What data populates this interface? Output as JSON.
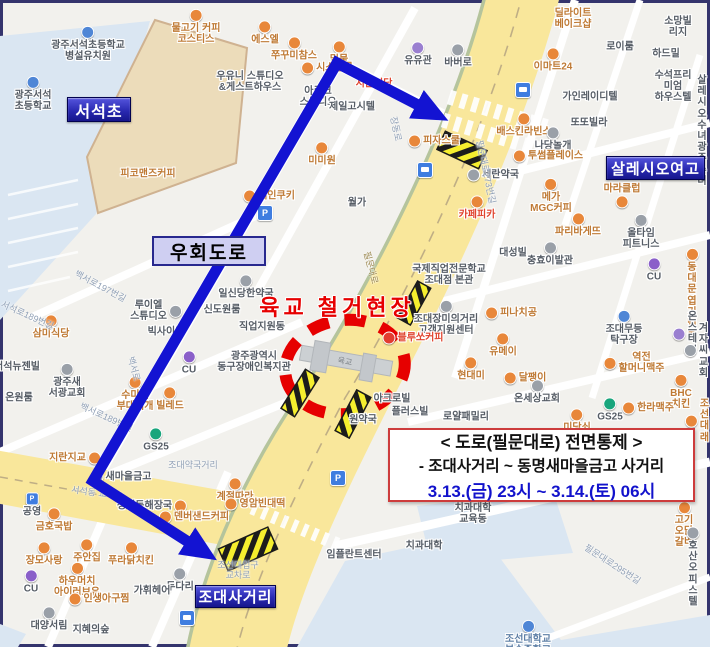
{
  "colors": {
    "map_bg": "#f2f1ed",
    "campus_blue": "#dae6f2",
    "field_tan": "#ecdcba",
    "road_yellow": "#f9e79b",
    "road_edge": "#b5c49c",
    "centerline": "#bfae85",
    "route": "#1313d2",
    "alert_red": "#e60000",
    "hatch_yellow": "#f5ee2e",
    "badge_top": "#5555dd",
    "badge_bottom": "#16168c",
    "badge_border": "#02024f",
    "detour_bg": "#cfcff2",
    "detour_border": "#28288e",
    "notice_border": "#cd3c3c",
    "notice_blue": "#1212cc"
  },
  "annotations": {
    "site_title": "육교 철거현장",
    "detour_label": "우회도로",
    "notice": {
      "title": "< 도로(필문대로) 전면통제 >",
      "range": "- 조대사거리 ~ 동명새마을금고 사거리",
      "time": "3.13.(금) 23시 ~ 3.14.(토) 06시"
    },
    "badges": [
      {
        "label": "서석초",
        "x": 67,
        "y": 97,
        "w": 62,
        "h": 23,
        "fs": 16
      },
      {
        "label": "살레시오여고",
        "x": 606,
        "y": 156,
        "w": 97,
        "h": 22,
        "fs": 15
      },
      {
        "label": "조대사거리",
        "x": 195,
        "y": 585,
        "w": 79,
        "h": 21,
        "fs": 15
      }
    ]
  },
  "map": {
    "pois": [
      {
        "t": "물고기 커피\n코스티스",
        "x": 196,
        "y": 27,
        "c": "food",
        "i": "a",
        "ic": "o"
      },
      {
        "t": "에스엘",
        "x": 265,
        "y": 33,
        "c": "food",
        "i": "a",
        "ic": "o"
      },
      {
        "t": "쭈꾸미참스",
        "x": 294,
        "y": 49,
        "c": "food",
        "i": "a",
        "ic": "o"
      },
      {
        "t": "밀물",
        "x": 339,
        "y": 53,
        "c": "food",
        "i": "a",
        "ic": "o"
      },
      {
        "t": "시스살롱",
        "x": 327,
        "y": 68,
        "c": "food",
        "i": "l",
        "ic": "o"
      },
      {
        "t": "유유관",
        "x": 418,
        "y": 54,
        "c": "gray",
        "i": "a",
        "ic": "v"
      },
      {
        "t": "바버로",
        "x": 458,
        "y": 56,
        "c": "gray",
        "i": "a",
        "ic": "g"
      },
      {
        "t": "광주서석초등학교\n병설유치원",
        "x": 88,
        "y": 44,
        "c": "gray",
        "i": "a",
        "ic": "b"
      },
      {
        "t": "광주서석\n초등학교",
        "x": 33,
        "y": 94,
        "c": "gray",
        "i": "a",
        "ic": "b"
      },
      {
        "t": "우유니 스튜디오\n&게스트하우스",
        "x": 250,
        "y": 82,
        "c": "gray",
        "i": "n"
      },
      {
        "t": "아르크\n스튜디오",
        "x": 318,
        "y": 97,
        "c": "gray",
        "i": "n"
      },
      {
        "t": "제일고시텔",
        "x": 352,
        "y": 107,
        "c": "gray",
        "i": "n"
      },
      {
        "t": "서문식당",
        "x": 374,
        "y": 84,
        "c": "hot",
        "i": "n"
      },
      {
        "t": "미미원",
        "x": 322,
        "y": 154,
        "c": "food",
        "i": "a",
        "ic": "o"
      },
      {
        "t": "피자스쿨",
        "x": 434,
        "y": 141,
        "c": "food",
        "i": "l",
        "ic": "o"
      },
      {
        "t": "딜라이트\n베이크샵",
        "x": 573,
        "y": 19,
        "c": "food",
        "i": "n"
      },
      {
        "t": "소망빌리지",
        "x": 678,
        "y": 27,
        "c": "gray",
        "i": "n"
      },
      {
        "t": "로이룸",
        "x": 620,
        "y": 47,
        "c": "gray",
        "i": "n"
      },
      {
        "t": "하드밀",
        "x": 666,
        "y": 54,
        "c": "gray",
        "i": "n"
      },
      {
        "t": "이마트24",
        "x": 553,
        "y": 60,
        "c": "food",
        "i": "a",
        "ic": "o"
      },
      {
        "t": "가인레이디텔",
        "x": 590,
        "y": 97,
        "c": "gray",
        "i": "n"
      },
      {
        "t": "수석프리미엄\n하우스텔",
        "x": 673,
        "y": 87,
        "c": "gray",
        "i": "n"
      },
      {
        "t": "또또빌라",
        "x": 589,
        "y": 123,
        "c": "gray",
        "i": "n"
      },
      {
        "t": "배스킨라빈스",
        "x": 524,
        "y": 125,
        "c": "food",
        "i": "a",
        "ic": "o"
      },
      {
        "t": "나당놀개",
        "x": 553,
        "y": 139,
        "c": "gray",
        "i": "a",
        "ic": "g"
      },
      {
        "t": "살레시오수녀\n광주수녀",
        "x": 702,
        "y": 131,
        "c": "gray",
        "i": "n"
      },
      {
        "t": "투썸플레이스",
        "x": 548,
        "y": 156,
        "c": "food",
        "i": "l",
        "ic": "o"
      },
      {
        "t": "세란약국",
        "x": 493,
        "y": 175,
        "c": "gray",
        "i": "l",
        "ic": "g"
      },
      {
        "t": "메가\nMGC커피",
        "x": 551,
        "y": 196,
        "c": "food",
        "i": "a",
        "ic": "o"
      },
      {
        "t": "마라클럽",
        "x": 622,
        "y": 196,
        "c": "food",
        "i": "b",
        "ic": "o"
      },
      {
        "t": "카페피카",
        "x": 477,
        "y": 208,
        "c": "hot",
        "i": "a",
        "ic": "o"
      },
      {
        "t": "파리바게뜨",
        "x": 578,
        "y": 225,
        "c": "food",
        "i": "a",
        "ic": "o"
      },
      {
        "t": "올타임\n피트니스",
        "x": 641,
        "y": 232,
        "c": "gray",
        "i": "a",
        "ic": "g"
      },
      {
        "t": "대성빌",
        "x": 513,
        "y": 253,
        "c": "gray",
        "i": "n"
      },
      {
        "t": "충효이발관",
        "x": 550,
        "y": 254,
        "c": "gray",
        "i": "a",
        "ic": "g"
      },
      {
        "t": "CU",
        "x": 654,
        "y": 270,
        "c": "gray",
        "i": "a",
        "ic": "cu"
      },
      {
        "t": "동대문\n엽기떡볶",
        "x": 692,
        "y": 294,
        "c": "food",
        "i": "a",
        "ic": "o"
      },
      {
        "t": "세인쿠키",
        "x": 269,
        "y": 196,
        "c": "food",
        "i": "l",
        "ic": "o"
      },
      {
        "t": "피코맨즈커피",
        "x": 148,
        "y": 174,
        "c": "food",
        "i": "n"
      },
      {
        "t": "월가",
        "x": 357,
        "y": 203,
        "c": "gray",
        "i": "n"
      },
      {
        "t": "국제직업전문학교\n조대점 본관",
        "x": 449,
        "y": 275,
        "c": "gray",
        "i": "n"
      },
      {
        "t": "일신당한약국",
        "x": 246,
        "y": 287,
        "c": "gray",
        "i": "a",
        "ic": "g"
      },
      {
        "t": "신도원룸",
        "x": 222,
        "y": 310,
        "c": "gray",
        "i": "n"
      },
      {
        "t": "직업지원동",
        "x": 262,
        "y": 327,
        "c": "gray",
        "i": "n"
      },
      {
        "t": "루이엘\n스튜디오",
        "x": 156,
        "y": 311,
        "c": "gray",
        "i": "r",
        "ic": "g"
      },
      {
        "t": "빅사이즈",
        "x": 166,
        "y": 332,
        "c": "gray",
        "i": "n"
      },
      {
        "t": "삼미식당",
        "x": 51,
        "y": 327,
        "c": "food",
        "i": "a",
        "ic": "o"
      },
      {
        "t": "광주광역시\n동구장애인복지관",
        "x": 254,
        "y": 362,
        "c": "gray",
        "i": "n"
      },
      {
        "t": "조대장미의거리\n고객지원센터",
        "x": 446,
        "y": 318,
        "c": "gray",
        "i": "a",
        "ic": "g"
      },
      {
        "t": "블루쏘커피",
        "x": 413,
        "y": 338,
        "c": "hot",
        "i": "l",
        "ic": "r"
      },
      {
        "t": "현대미",
        "x": 471,
        "y": 369,
        "c": "food",
        "i": "a",
        "ic": "o"
      },
      {
        "t": "피나치공",
        "x": 511,
        "y": 313,
        "c": "food",
        "i": "l",
        "ic": "o"
      },
      {
        "t": "유메이",
        "x": 503,
        "y": 345,
        "c": "food",
        "i": "a",
        "ic": "o"
      },
      {
        "t": "조대무등\n탁구장",
        "x": 624,
        "y": 328,
        "c": "gray",
        "i": "a",
        "ic": "b"
      },
      {
        "t": "온스테이",
        "x": 685,
        "y": 334,
        "c": "gray",
        "i": "l",
        "ic": "v"
      },
      {
        "t": "겨자씨교회",
        "x": 696,
        "y": 351,
        "c": "gray",
        "i": "l",
        "ic": "g"
      },
      {
        "t": "달팽이",
        "x": 525,
        "y": 378,
        "c": "food",
        "i": "l",
        "ic": "o"
      },
      {
        "t": "온세상교회",
        "x": 537,
        "y": 392,
        "c": "gray",
        "i": "a",
        "ic": "g"
      },
      {
        "t": "역전\n할머니맥주",
        "x": 634,
        "y": 363,
        "c": "food",
        "i": "l",
        "ic": "o"
      },
      {
        "t": "BHC치킨",
        "x": 681,
        "y": 392,
        "c": "food",
        "i": "a",
        "ic": "o"
      },
      {
        "t": "GS25",
        "x": 610,
        "y": 410,
        "c": "gray",
        "i": "a",
        "ic": "gs"
      },
      {
        "t": "한라맥주",
        "x": 648,
        "y": 408,
        "c": "food",
        "i": "l",
        "ic": "o"
      },
      {
        "t": "미당쇠",
        "x": 577,
        "y": 421,
        "c": "food",
        "i": "a",
        "ic": "o"
      },
      {
        "t": "조선대래",
        "x": 697,
        "y": 421,
        "c": "food",
        "i": "l",
        "ic": "o"
      },
      {
        "t": "아크로빌",
        "x": 392,
        "y": 399,
        "c": "gray",
        "i": "n"
      },
      {
        "t": "플러스빌",
        "x": 410,
        "y": 412,
        "c": "gray",
        "i": "n"
      },
      {
        "t": "로얄패밀리",
        "x": 466,
        "y": 417,
        "c": "gray",
        "i": "n"
      },
      {
        "t": "원약국",
        "x": 363,
        "y": 420,
        "c": "gray",
        "i": "n"
      },
      {
        "t": "수미네\n부대찌개",
        "x": 135,
        "y": 394,
        "c": "food",
        "i": "a",
        "ic": "o"
      },
      {
        "t": "빌레드",
        "x": 170,
        "y": 399,
        "c": "food",
        "i": "a",
        "ic": "o"
      },
      {
        "t": "CU",
        "x": 189,
        "y": 363,
        "c": "gray",
        "i": "a",
        "ic": "cu"
      },
      {
        "t": "GS25",
        "x": 156,
        "y": 440,
        "c": "gray",
        "i": "a",
        "ic": "gs"
      },
      {
        "t": "서석뉴젠빌",
        "x": 17,
        "y": 367,
        "c": "gray",
        "i": "n"
      },
      {
        "t": "광주새\n서광교회",
        "x": 67,
        "y": 381,
        "c": "gray",
        "i": "a",
        "ic": "g"
      },
      {
        "t": "온원룸",
        "x": 19,
        "y": 398,
        "c": "gray",
        "i": "n"
      },
      {
        "t": "지란지교",
        "x": 75,
        "y": 458,
        "c": "food",
        "i": "r",
        "ic": "o"
      },
      {
        "t": "새마을금고",
        "x": 121,
        "y": 477,
        "c": "gray",
        "i": "l",
        "ic": "g"
      },
      {
        "t": "공영",
        "x": 32,
        "y": 505,
        "c": "gray",
        "i": "a",
        "ic": "p"
      },
      {
        "t": "금호국밥",
        "x": 54,
        "y": 520,
        "c": "food",
        "i": "a",
        "ic": "o"
      },
      {
        "t": "장모사랑",
        "x": 44,
        "y": 554,
        "c": "food",
        "i": "a",
        "ic": "o"
      },
      {
        "t": "주안집",
        "x": 87,
        "y": 551,
        "c": "food",
        "i": "a",
        "ic": "o"
      },
      {
        "t": "하우머치\n아이러브유",
        "x": 77,
        "y": 580,
        "c": "food",
        "i": "a",
        "ic": "o"
      },
      {
        "t": "CU",
        "x": 31,
        "y": 582,
        "c": "gray",
        "i": "a",
        "ic": "cu"
      },
      {
        "t": "인생아구찜",
        "x": 99,
        "y": 599,
        "c": "food",
        "i": "l",
        "ic": "o"
      },
      {
        "t": "대양서림",
        "x": 49,
        "y": 619,
        "c": "gray",
        "i": "a",
        "ic": "g"
      },
      {
        "t": "지혜의숲",
        "x": 91,
        "y": 630,
        "c": "gray",
        "i": "n"
      },
      {
        "t": "청진동해장국",
        "x": 152,
        "y": 506,
        "c": "gray",
        "i": "r",
        "ic": "o"
      },
      {
        "t": "덴버샌드커피",
        "x": 194,
        "y": 517,
        "c": "food",
        "i": "l",
        "ic": "o"
      },
      {
        "t": "계절따라",
        "x": 235,
        "y": 490,
        "c": "food",
        "i": "a",
        "ic": "o"
      },
      {
        "t": "영암빈대떡",
        "x": 255,
        "y": 504,
        "c": "food",
        "i": "l",
        "ic": "o"
      },
      {
        "t": "푸라닭치킨",
        "x": 131,
        "y": 554,
        "c": "food",
        "i": "a",
        "ic": "o"
      },
      {
        "t": "두다리",
        "x": 180,
        "y": 580,
        "c": "gray",
        "i": "a",
        "ic": "g"
      },
      {
        "t": "가휘헤어",
        "x": 152,
        "y": 591,
        "c": "gray",
        "i": "n"
      },
      {
        "t": "임플란트센터",
        "x": 354,
        "y": 555,
        "c": "gray",
        "i": "n"
      },
      {
        "t": "치과대학",
        "x": 424,
        "y": 546,
        "c": "gray",
        "i": "n"
      },
      {
        "t": "치과대학\n교육동",
        "x": 473,
        "y": 514,
        "c": "gray",
        "i": "n"
      },
      {
        "t": "고기오닭갈비",
        "x": 684,
        "y": 525,
        "c": "food",
        "i": "a",
        "ic": "o"
      },
      {
        "t": "호산오피스텔",
        "x": 693,
        "y": 567,
        "c": "gray",
        "i": "a",
        "ic": "g"
      },
      {
        "t": "조선대학교\n부속중학교",
        "x": 528,
        "y": 638,
        "c": "campus",
        "i": "a",
        "ic": "b"
      }
    ],
    "road_labels": [
      {
        "t": "백서로197번길",
        "x": 100,
        "y": 287,
        "r": 28
      },
      {
        "t": "서석로189번길",
        "x": 27,
        "y": 316,
        "r": 24
      },
      {
        "t": "백서로189번길",
        "x": 106,
        "y": 418,
        "r": 24
      },
      {
        "t": "백서로",
        "x": 133,
        "y": 369,
        "r": 75
      },
      {
        "t": "장동로",
        "x": 395,
        "y": 129,
        "r": 78
      },
      {
        "t": "필문대로273번길",
        "x": 485,
        "y": 172,
        "r": 78
      },
      {
        "t": "필문대로295번길",
        "x": 612,
        "y": 565,
        "r": 33
      },
      {
        "t": "조대약국거리",
        "x": 193,
        "y": 466,
        "r": 0
      },
      {
        "t": "서석동 교차로",
        "x": 97,
        "y": 494,
        "r": 8
      },
      {
        "t": "조선대입구\n교차로",
        "x": 238,
        "y": 571,
        "r": 0
      },
      {
        "t": "필문대로",
        "x": 370,
        "y": 268,
        "r": 75,
        "on": "road"
      }
    ],
    "transit_icons": [
      {
        "k": "bus",
        "x": 523,
        "y": 90
      },
      {
        "k": "bus",
        "x": 425,
        "y": 170
      },
      {
        "k": "bus",
        "x": 187,
        "y": 618
      },
      {
        "k": "p",
        "x": 265,
        "y": 213
      },
      {
        "k": "p",
        "x": 338,
        "y": 478
      }
    ]
  }
}
